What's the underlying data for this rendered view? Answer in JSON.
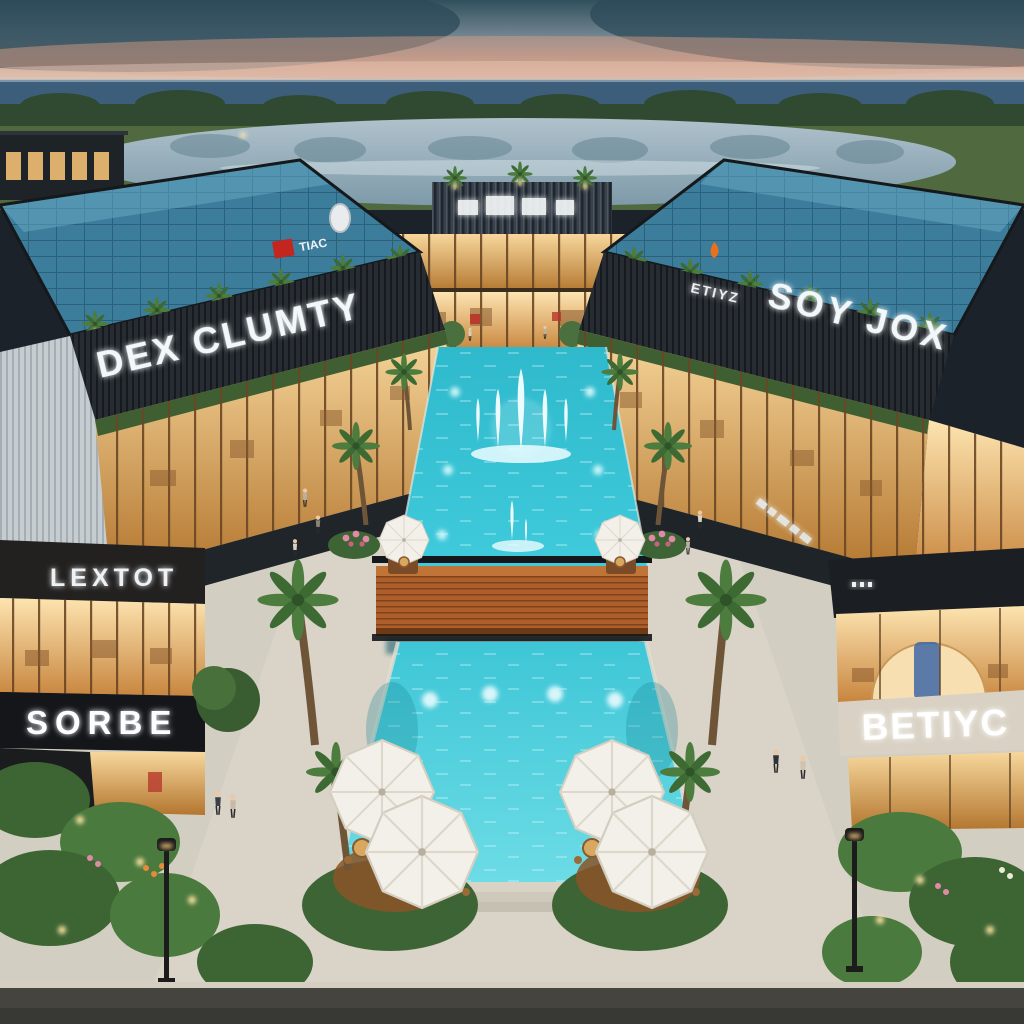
{
  "signs": {
    "left_building_upper": "DEX CLUMTY",
    "left_building_logo": "TIAC",
    "left_building_mid": "LEXTOT",
    "left_building_lower": "SORBE",
    "right_building_logo": "ETIYZ",
    "right_building_upper": "SOY JOX",
    "right_building_lower": "BETIYC"
  },
  "palette": {
    "sky_top": "#30505e",
    "sunset_band": "#cfa08c",
    "sea": "#3d5e7b",
    "lake": "#93abb8",
    "grass": "#50693f",
    "facade_dark": "#24292f",
    "solar_roof": "#3c7d9c",
    "interior_warm": "#f2c684",
    "canal_water": "#35c6d8",
    "pool_water": "#4fd0dd",
    "bridge_corten": "#a85a28",
    "umbrella_white": "#f3f0e9",
    "palm_green": "#4c7c3e",
    "pavement": "#d3cec2",
    "accent_red": "#c3261f",
    "accent_orange": "#e8701f"
  }
}
